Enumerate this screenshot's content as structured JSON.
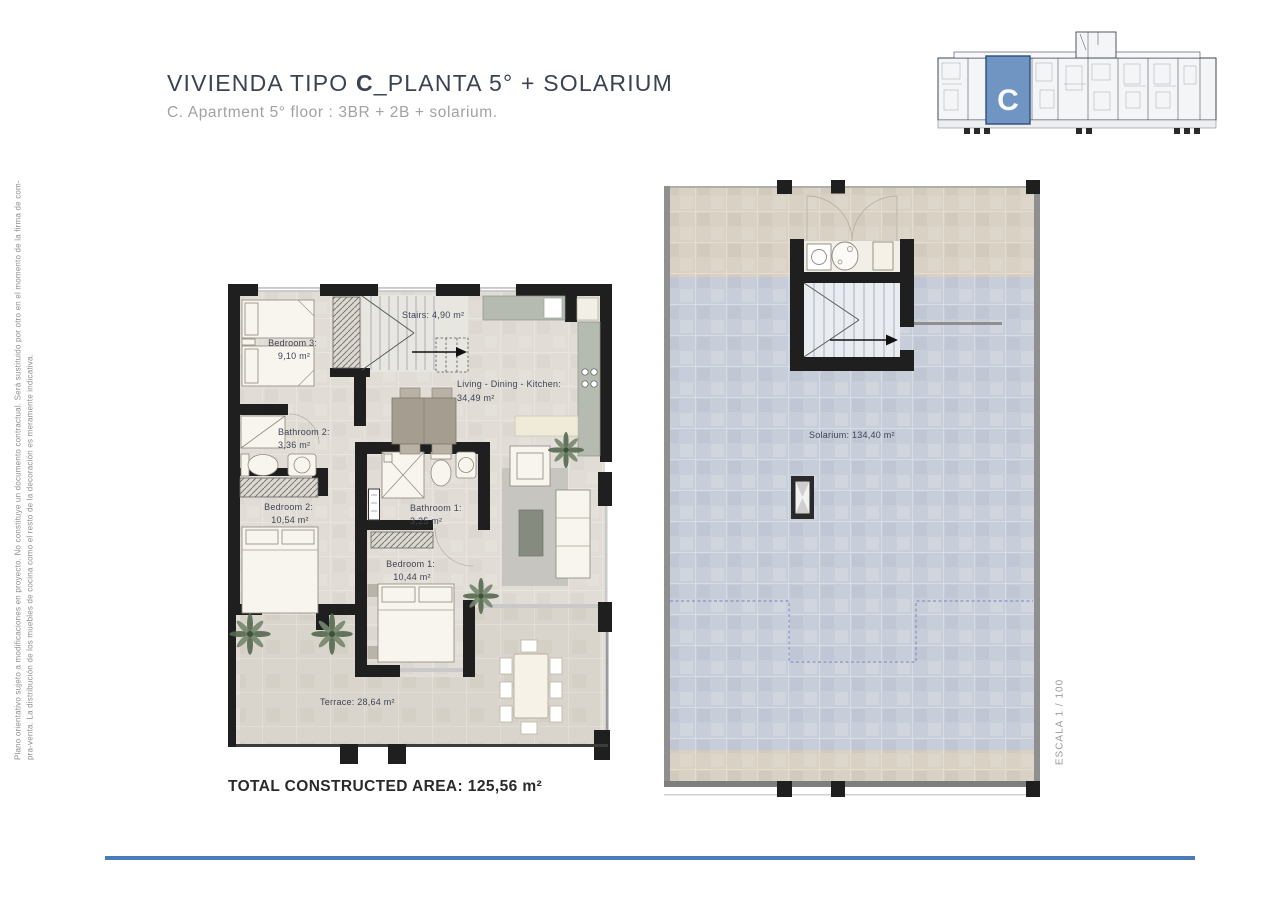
{
  "header": {
    "title_prefix": "VIVIENDA TIPO ",
    "title_bold": "C",
    "title_suffix": "_PLANTA 5° + SOLARIUM",
    "subtitle": "C. Apartment 5° floor : 3BR + 2B + solarium."
  },
  "side_notes": {
    "disclaimer_line1": "Plano orientativo sujeto a modificaciones en proyecto. No constituye un documento contractual. Será sustituido por otro en el momento de la firma de com-",
    "disclaimer_line2": "pra-venta. La distribución de los muebles de cocina como el resto de la decoración es meramente indicativa.",
    "scale": "ESCALA 1 / 100"
  },
  "key_plan": {
    "unit_label": "C"
  },
  "apartment": {
    "rooms": [
      {
        "id": "bedroom3",
        "name": "Bedroom 3:",
        "area": "9,10 m²"
      },
      {
        "id": "stairs",
        "label": "Stairs: 4,90 m²"
      },
      {
        "id": "living",
        "name": "Living - Dining - Kitchen:",
        "area": "34,49 m²"
      },
      {
        "id": "bathroom2",
        "name": "Bathroom 2:",
        "area": "3,36 m²"
      },
      {
        "id": "bedroom2",
        "name": "Bedroom 2:",
        "area": "10,54 m²"
      },
      {
        "id": "bathroom1",
        "name": "Bathroom 1:",
        "area": "3,25 m²"
      },
      {
        "id": "bedroom1",
        "name": "Bedroom 1:",
        "area": "10,44 m²"
      },
      {
        "id": "terrace",
        "label": "Terrace: 28,64 m²"
      }
    ],
    "total": "TOTAL CONSTRUCTED AREA: 125,56 m²"
  },
  "solarium": {
    "label": "Solarium: 134,40 m²"
  },
  "colors": {
    "accent_blue": "#7095c3",
    "accent_blue_border": "#2f4d7c",
    "divider_blue": "#4a7cb8",
    "title_color": "#3b4252",
    "muted_text": "#a2a2a2",
    "wall_black": "#1f1f1f"
  }
}
